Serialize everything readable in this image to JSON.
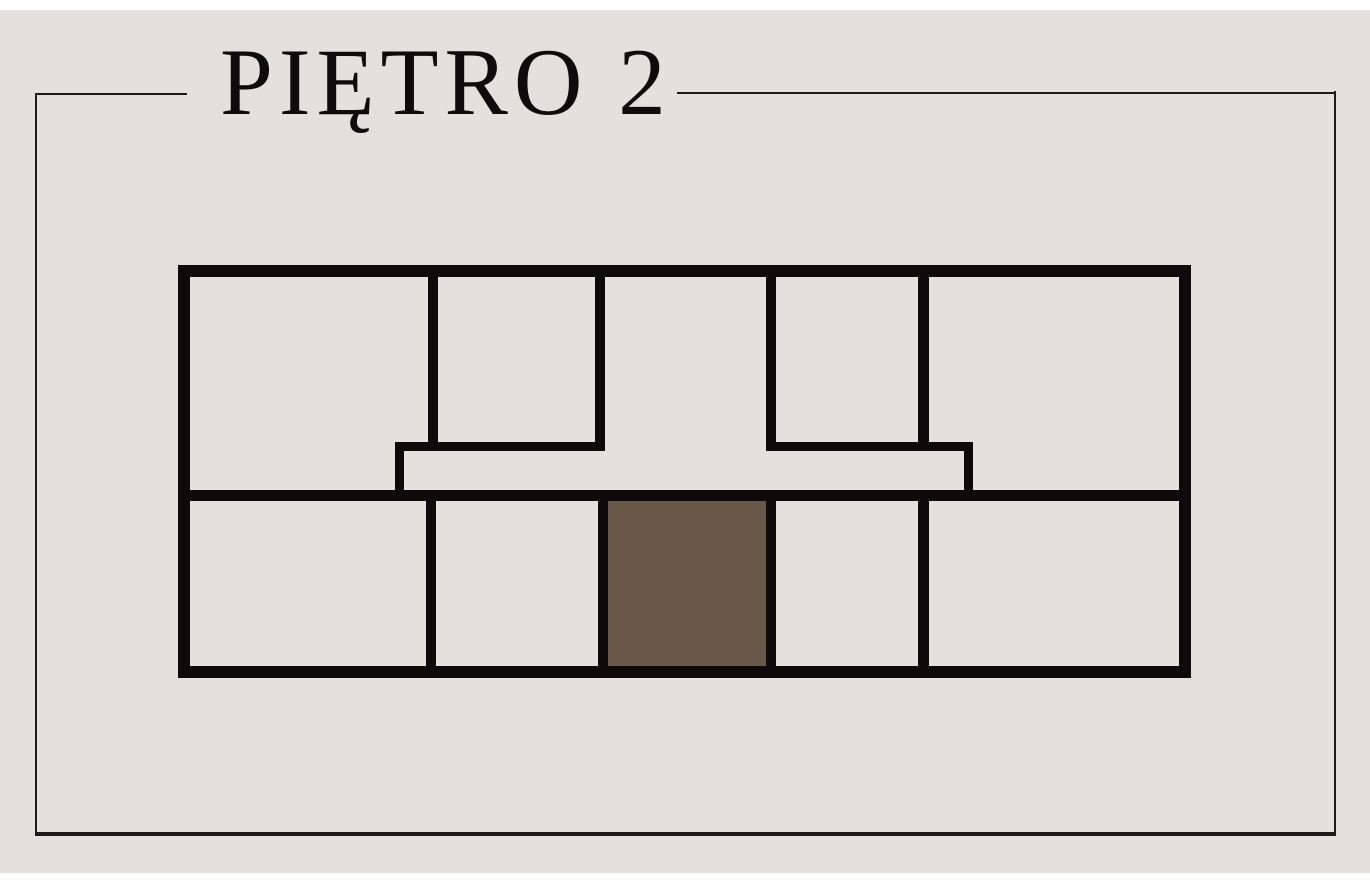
{
  "colors": {
    "bg": "#e4e1dc",
    "margin": "#ffffff",
    "wall": "#0c0b09",
    "highlight": "#695747",
    "frame": "#1c1b19",
    "title": "#0d0c0a"
  },
  "header": {
    "title": "PIĘTRO 2"
  },
  "floor_plan": {
    "highlighted_room": "bottom-center",
    "rooms": [
      {
        "id": "top-left",
        "highlighted": false
      },
      {
        "id": "top-left-center",
        "highlighted": false
      },
      {
        "id": "top-center-hall",
        "highlighted": false
      },
      {
        "id": "top-right-center",
        "highlighted": false
      },
      {
        "id": "top-right",
        "highlighted": false
      },
      {
        "id": "corridor",
        "highlighted": false
      },
      {
        "id": "bottom-left",
        "highlighted": false
      },
      {
        "id": "bottom-left-center",
        "highlighted": false
      },
      {
        "id": "bottom-center",
        "highlighted": true
      },
      {
        "id": "bottom-right-center",
        "highlighted": false
      },
      {
        "id": "bottom-right",
        "highlighted": false
      }
    ]
  }
}
